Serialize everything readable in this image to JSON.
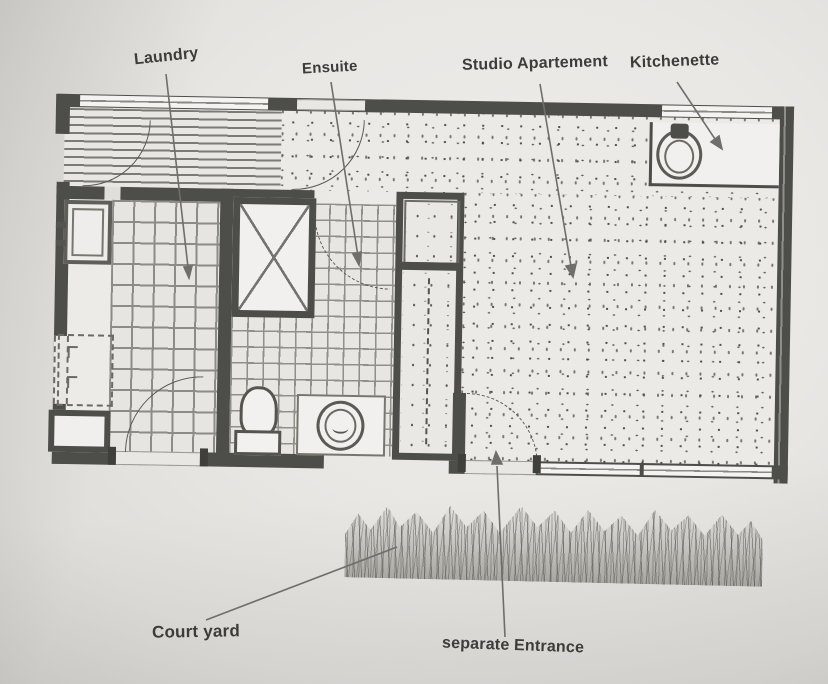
{
  "image": {
    "kind": "photographed floor plan",
    "width": 828,
    "height": 684
  },
  "palette": {
    "paper": "#e9e7e4",
    "wall_ink": "#4d4d49",
    "tile_line": "#8c8c87",
    "label_ink": "#3d3c3a",
    "leader_line": "#6e6e6a"
  },
  "labels": {
    "laundry": "Laundry",
    "ensuite": "Ensuite",
    "studio_apartment": "Studio Apartement",
    "kitchenette": "Kitchenette",
    "court_yard": "Court yard",
    "separate_entrance": "separate Entrance"
  },
  "rooms": [
    {
      "name": "laundry",
      "floor": "large square tiles"
    },
    {
      "name": "ensuite",
      "floor": "small square tiles"
    },
    {
      "name": "studio-apartment",
      "floor": "stippled carpet"
    },
    {
      "name": "entry-hall",
      "floor": "horizontal striped boards"
    },
    {
      "name": "wardrobe",
      "floor": "sparse stipple with hanging rail"
    }
  ],
  "fixtures": [
    "laundry-tub",
    "washing-machine-space",
    "laundry-cabinet",
    "shower",
    "toilet",
    "vanity-basin",
    "wardrobe-rail",
    "kitchen-sink",
    "kitchenette-counter",
    "entrance-door",
    "windows",
    "grass-strip"
  ]
}
